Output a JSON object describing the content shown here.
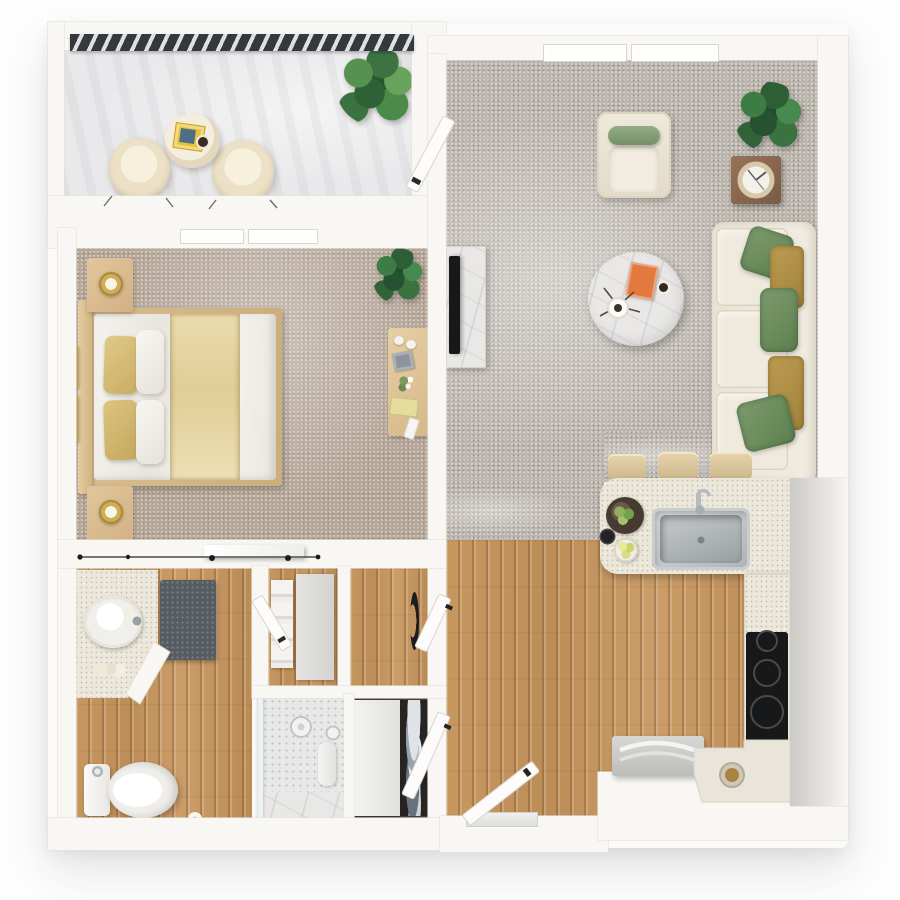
{
  "scene": {
    "title": "3D rendered top-down floor plan of a one-bedroom apartment with balcony",
    "width_px": 900,
    "height_px": 900
  },
  "palette": {
    "wall": "#f8f7f4",
    "wall-edge": "#e4e1da",
    "balcony-floor": "#e9e9eb",
    "railing": "#35393e",
    "carpet-living": "#bcb6ae",
    "carpet-bedroom": "#b6a798",
    "wood": "#c2945f",
    "counter": "#ece7db",
    "marble": "#e9e8e6",
    "tv-black": "#17181a",
    "steel": "#b4b9bb",
    "mat-gray": "#575c62",
    "side-table-brown": "#8a6750",
    "pillow-green": "#6c8e60",
    "pillow-gold": "#b29148",
    "plant-green": "#2d5e35",
    "fixture-white": "#f6f5f2",
    "closet-dark": "#272320",
    "book-orange": "#e2793f",
    "bed-runner-tan": "#e5d2a2",
    "pillow-yellow": "#d8bf77",
    "gray-band": "#d8d7d4"
  },
  "rooms": {
    "balcony": {
      "label": "Balcony",
      "items": [
        "metal railing",
        "two round lounge chairs",
        "bistro table with magazine and coffee cup",
        "potted plant"
      ]
    },
    "living_room": {
      "label": "Living room",
      "items": [
        "double window",
        "open balcony door",
        "TV on marble media console",
        "armchair with green bolster",
        "potted plant",
        "square wood side table with decor tray",
        "sofa with green and gold pillows",
        "gallery wall of four frames",
        "round marble coffee table with book, vase and cup"
      ]
    },
    "bedroom": {
      "label": "Bedroom",
      "items": [
        "window",
        "double bed with tan runner and yellow pillows",
        "two nightstands with lamps",
        "two framed artworks",
        "potted plant",
        "desk with cups, frame, flowers and notebook",
        "sliding barn door"
      ]
    },
    "kitchen": {
      "label": "Kitchen",
      "items": [
        "island with stainless sink and three bar stools",
        "fruit plate and dishes",
        "cooktop counter",
        "corner counter with bowl",
        "refrigerator"
      ]
    },
    "entry_hall": {
      "label": "Entry hall",
      "items": [
        "entry door with threshold",
        "two open interior doors"
      ]
    },
    "bathroom": {
      "label": "Bathroom",
      "items": [
        "vanity with round vessel sink",
        "wall cabinet",
        "dark bath mat",
        "open door",
        "toilet",
        "toilet paper roll",
        "walk-in shower with bench and rain head"
      ]
    },
    "closets": {
      "label": "Closet area",
      "items": [
        "linen closet with towels",
        "washer-dryer unit",
        "wardrobe with hanging clothes"
      ]
    }
  }
}
